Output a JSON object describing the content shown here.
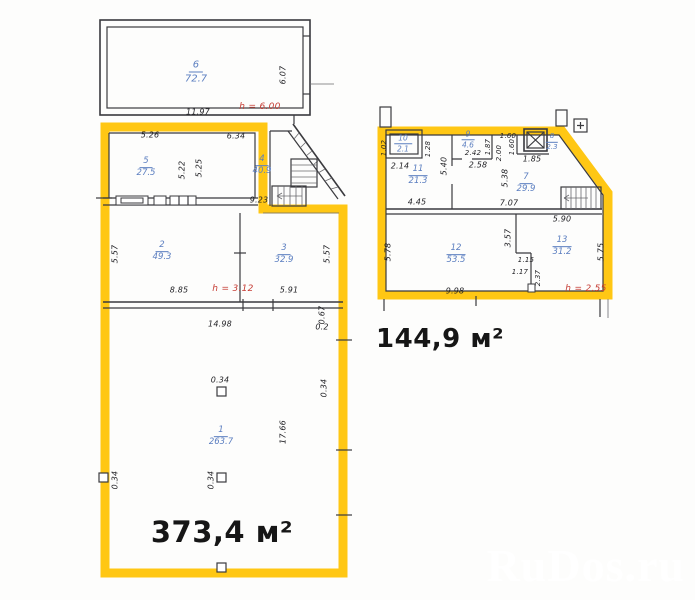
{
  "colors": {
    "highlight": "#FFC714",
    "wall": "#3a3a3e",
    "dim": "#1f1f23",
    "room_label": "#5b7ec0",
    "height_label": "#c63d35",
    "wm_shadow": "#4a4a4a"
  },
  "watermark": "RuDos.ru",
  "left_plan": {
    "area_label": "373,4 м²",
    "rooms": {
      "r6": {
        "num": "6",
        "area": "72.7"
      },
      "r5": {
        "num": "5",
        "area": "27.5"
      },
      "r4": {
        "num": "4",
        "area": "40.9"
      },
      "r2": {
        "num": "2",
        "area": "49.3"
      },
      "r3": {
        "num": "3",
        "area": "32.9"
      },
      "r1": {
        "num": "1",
        "area": "263.7"
      }
    },
    "heights": {
      "h6": "h = 6.00",
      "h23": "h = 3.12"
    },
    "dims": {
      "w6": "11.97",
      "d607": "6.07",
      "w5": "5.26",
      "d522": "5.22",
      "d525": "5.25",
      "w4": "6.34",
      "w4b": "9.23",
      "d557l": "5.57",
      "w2b": "8.85",
      "w3b": "5.91",
      "d557r": "5.57",
      "w1t": "14.98",
      "d067": "0.67",
      "d02": "0.2",
      "d034a": "0.34",
      "d1766": "17.66",
      "d034b": "0.34",
      "d034c": "0.34",
      "d034d": "0.34"
    }
  },
  "right_plan": {
    "area_label": "144,9 м²",
    "markers": {
      "plus": "+"
    },
    "rooms": {
      "r10": {
        "num": "10",
        "area": "2.1"
      },
      "r11": {
        "num": "11",
        "area": "21.3"
      },
      "r9": {
        "num": "9",
        "area": "4.6"
      },
      "r8": {
        "num": "8",
        "area": "2.3"
      },
      "r7": {
        "num": "7",
        "area": "29.9"
      },
      "r12": {
        "num": "12",
        "area": "53.5"
      },
      "r13": {
        "num": "13",
        "area": "31.2"
      }
    },
    "heights": {
      "h1213": "h = 2.55"
    },
    "dims": {
      "d102": "1.02",
      "d128": "1.28",
      "d214": "2.14",
      "d540": "5.40",
      "d242": "2.42",
      "d258": "2.58",
      "d187": "1.87",
      "d200": "2.00",
      "d160a": "1.60",
      "d160b": "1.60",
      "d185": "1.85",
      "d538": "5.38",
      "d445": "4.45",
      "d707": "7.07",
      "d590": "5.90",
      "d578": "5.78",
      "d575": "5.75",
      "d357": "3.57",
      "d115": "1.15",
      "d117": "1.17",
      "d237": "2.37",
      "d998": "9.98"
    }
  }
}
